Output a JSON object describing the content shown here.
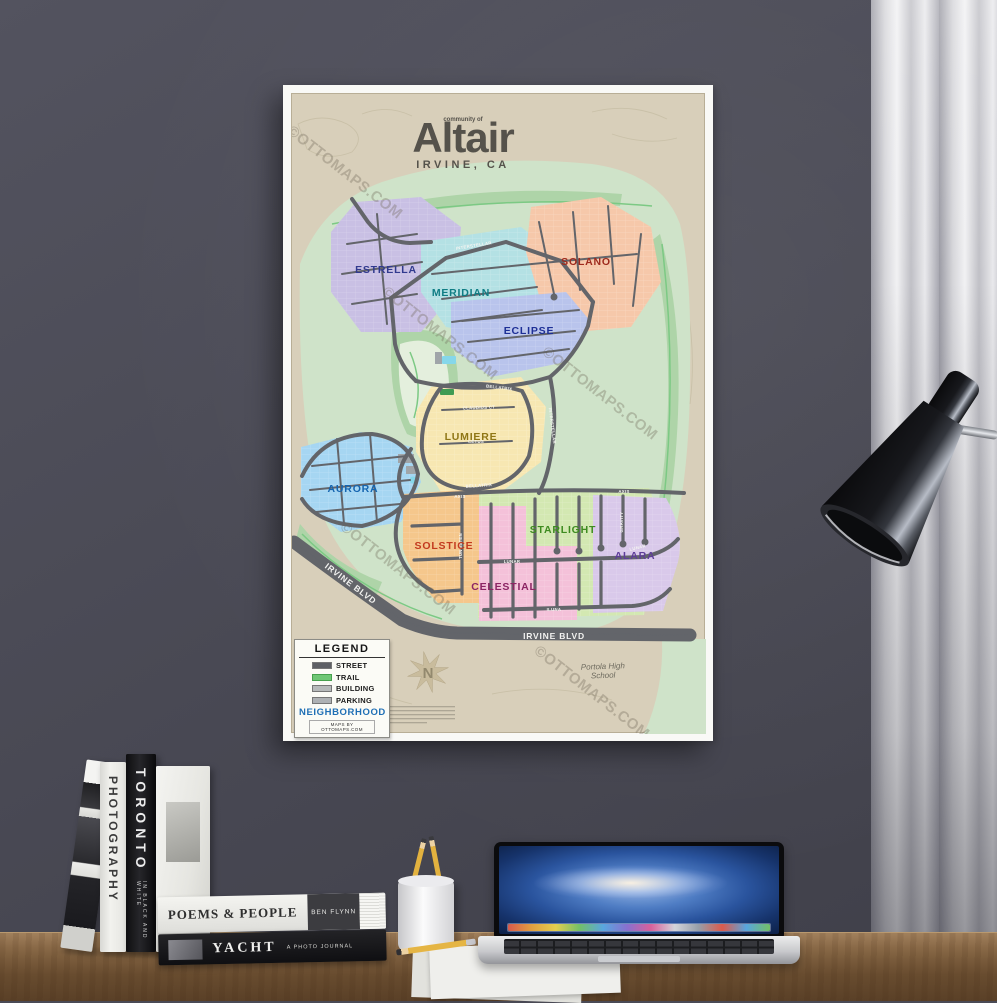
{
  "poster": {
    "watermark": "©OTTOMAPS.COM",
    "title": {
      "community": "community of",
      "name": "Altair",
      "location": "IRVINE, CA"
    },
    "neighborhoods": [
      {
        "name": "ESTRELLA",
        "fill": "#c9c0e4",
        "label_color": "#313a8e"
      },
      {
        "name": "MERIDIAN",
        "fill": "#b4e1e4",
        "label_color": "#0f7d84"
      },
      {
        "name": "SOLANO",
        "fill": "#f6c8aa",
        "label_color": "#9e2a1d"
      },
      {
        "name": "ECLIPSE",
        "fill": "#b9c4ec",
        "label_color": "#1d2f96"
      },
      {
        "name": "LUMIERE",
        "fill": "#f7e7b2",
        "label_color": "#8f7616"
      },
      {
        "name": "AURORA",
        "fill": "#a6d6f2",
        "label_color": "#1565b0"
      },
      {
        "name": "SOLSTICE",
        "fill": "#f5c78c",
        "label_color": "#c33b1f"
      },
      {
        "name": "STARLIGHT",
        "fill": "#d3e8b2",
        "label_color": "#3e8b20"
      },
      {
        "name": "CELESTIAL",
        "fill": "#f4c1d9",
        "label_color": "#8c2564"
      },
      {
        "name": "ALARA",
        "fill": "#d9c9ea",
        "label_color": "#5e3d99"
      }
    ],
    "streets": {
      "interstellar": "INTERSTELLAR",
      "axis": "AXIS",
      "lunar": "LUNAR",
      "iluna": "ILUNA",
      "bellatrix": "BELLATRIX",
      "claudius": "CLAUDIUS CT",
      "cetus": "CETUS",
      "gravity": "GRAVITY",
      "tungsten": "TUNGSTEN"
    },
    "main_road": "IRVINE BLVD",
    "school": "Portola High School",
    "legend": {
      "title": "LEGEND",
      "items": [
        {
          "label": "STREET",
          "color": "#5e6065"
        },
        {
          "label": "TRAIL",
          "color": "#6fc776"
        },
        {
          "label": "BUILDING",
          "color": "#b6b9ba"
        },
        {
          "label": "PARKING",
          "color": "#aeb1b4"
        }
      ],
      "footer": "NEIGHBORHOOD",
      "footer_color": "#1f6fb5",
      "credit": "MAPS BY OTTOMAPS.COM",
      "compass": "N"
    }
  },
  "desk": {
    "books": {
      "toronto": "TORONTO",
      "toronto_sub": "IN BLACK AND WHITE",
      "photography": "PHOTOGRAPHY",
      "poems": "POEMS & PEOPLE",
      "poems_author": "BEN FLYNN",
      "yacht": "YACHT",
      "yacht_sub": "A PHOTO JOURNAL"
    }
  }
}
